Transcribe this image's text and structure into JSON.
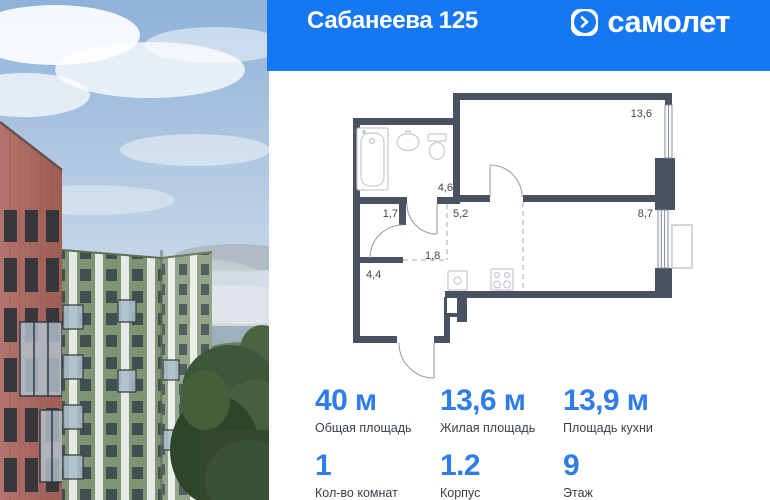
{
  "header": {
    "title": "Сабанеева 125",
    "brand_name": "самолет"
  },
  "floor_plan": {
    "room_areas": [
      "13,6",
      "4,6",
      "1,7",
      "5,2",
      "1,8",
      "4,4",
      "8,7"
    ]
  },
  "stats": {
    "areas": [
      {
        "value": "40 м",
        "label": "Общая площадь"
      },
      {
        "value": "13,6 м",
        "label": "Жилая площадь"
      },
      {
        "value": "13,9 м",
        "label": "Площадь кухни"
      }
    ],
    "details": [
      {
        "value": "1",
        "label": "Кол-во комнат"
      },
      {
        "value": "1.2",
        "label": "Корпус"
      },
      {
        "value": "9",
        "label": "Этаж"
      }
    ]
  },
  "colors": {
    "header_blue": "#1677F2",
    "stat_blue": "#2F7DE8",
    "wall_dark": "#4A5160"
  }
}
